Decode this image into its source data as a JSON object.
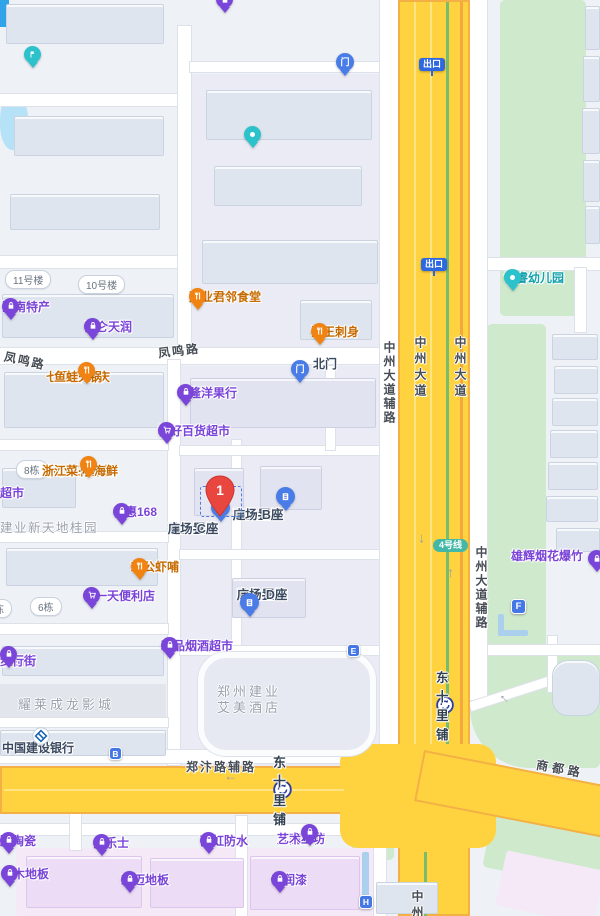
{
  "colors": {
    "road_yellow": "#ffd23f",
    "poi_purple": "#7a44d8",
    "poi_orange": "#c56a00",
    "poi_navy": "#3b4a61",
    "poi_teal": "#13a3ae",
    "marker_blue": "#4577e6",
    "pin_red": "#e8463f",
    "park_green": "#cfe9cd",
    "metro_line4_teal": "#44b8a7"
  },
  "roads": {
    "fengming": "凤鸣路",
    "zhongzhou_avenue": "中州大道",
    "zhongzhou_auxiliary": "中州大道辅路",
    "zhengbian_auxiliary": "郑汴路辅路",
    "shangdu": "商都路",
    "zhongzhou_clipped": "中州"
  },
  "transit": {
    "exit_sign": "出口",
    "line4_badge": "4号线",
    "station_dong_shi_li_pu": "东十里铺"
  },
  "markers": {
    "selected_pin_number": "1",
    "north_gate": "北门",
    "letter_b": "B",
    "letter_e": "E",
    "letter_f": "F",
    "letter_h": "H"
  },
  "building_pills": {
    "no11": "11号楼",
    "no10": "10号楼",
    "no8": "8栋",
    "no6": "6栋",
    "partial": "栋"
  },
  "area_labels": {
    "jianye_xintiandi": "建业新天地桂园",
    "yaolai_cinema": "耀莱成龙影城",
    "hotel_line1": "郑州建业",
    "hotel_line2": "艾美酒店"
  },
  "pois": {
    "henan_techan": "河南特产",
    "kunlun_tianrun": "昆仑天润",
    "qilitian_line1": "七里田·重庆",
    "qilitian_line2": "鱼蛙火锅",
    "junlin_canteen": "建业君邻食堂",
    "haiwang_sashimi": "海王刺身",
    "dilong_fruit": "帝隆洋果行",
    "meihao_market": "梅好百货超市",
    "jiangnan_line1": "小小江南菜馆",
    "jiangnan_line2": "浙江菜·小海鲜",
    "supermarket_partial": "超市",
    "baihui168": "佰惠168",
    "jigong_prawn": "鸡公虾哺",
    "everyday_store": "每一天便利店",
    "zhidi_line1": "置地桂园",
    "zhidi_line2": "步行街",
    "tobacco_shop": "精品烟酒超市",
    "ccb_bank": "中国建设银行",
    "plaza_line1": "建业置地",
    "plaza_c_line2": "广场-C座",
    "plaza_b_line2": "广场-B座",
    "plaza_d_line2": "广场-D座",
    "xionghui_fireworks": "雄辉烟花爆竹",
    "borui_kindergarten": "博睿幼儿园",
    "dulux": "多乐士",
    "peng_ceramics": "鹏陶瓷",
    "yuhong_waterproof": "雨虹防水",
    "fangao_line1": "凡高石膏",
    "fangao_line2": "艺术工坊",
    "shimu_flooring": "世木地板",
    "hongmai_flooring": "宏迈地板",
    "huarun_paint": "华润漆"
  }
}
